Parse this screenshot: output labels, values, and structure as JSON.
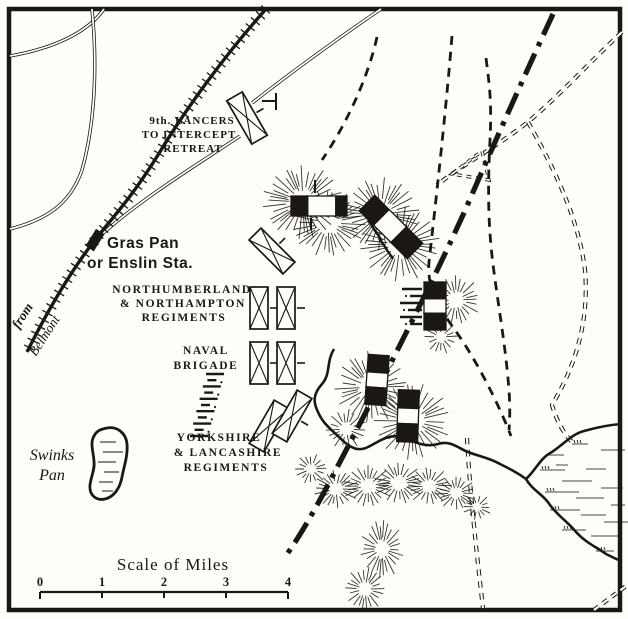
{
  "colors": {
    "ink": "#1b1814",
    "paper": "#fdfdfa"
  },
  "annotations": {
    "lancers": {
      "lines": [
        "9th. LANCERS",
        "TO INTERCEPT",
        "RETREAT"
      ]
    },
    "station": {
      "lines": [
        "Gras Pan",
        "or Enslin Sta."
      ]
    },
    "from_belmont": {
      "from": "from",
      "belmont": "Belmont"
    },
    "northumberland": {
      "lines": [
        "NORTHUMBERLAND",
        "& NORTHAMPTON",
        "REGIMENTS"
      ]
    },
    "naval": {
      "lines": [
        "NAVAL",
        "BRIGADE"
      ]
    },
    "yorkshire": {
      "lines": [
        "YORKSHIRE",
        "& LANCASHIRE",
        "REGIMENTS"
      ]
    },
    "swinks": {
      "lines": [
        "Swinks",
        "Pan"
      ]
    }
  },
  "scale_bar": {
    "title": "Scale of Miles",
    "ticks": [
      "0",
      "1",
      "2",
      "3",
      "4"
    ]
  }
}
